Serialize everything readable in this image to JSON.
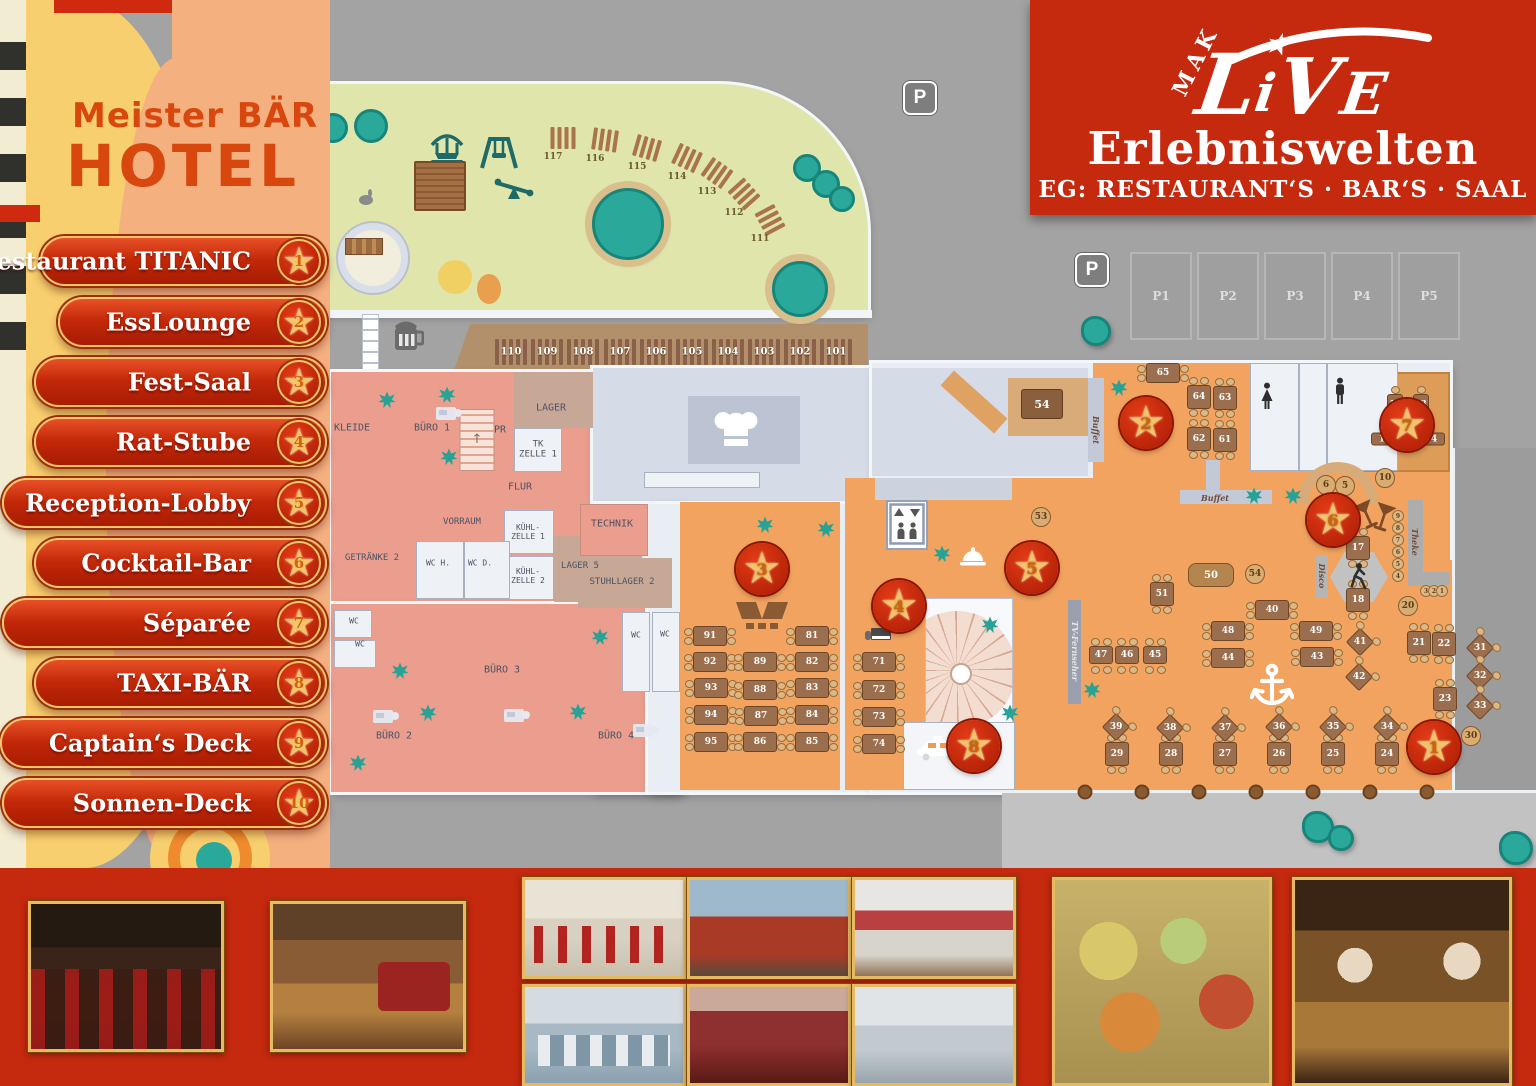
{
  "branding": {
    "hotel_line1": "Meister BÄR",
    "hotel_line2": "HOTEL",
    "mak": "MAK",
    "live_l": "L",
    "live_i": "i",
    "live_v": "V",
    "live_e": "E",
    "live_star": "★",
    "subtitle": "Erlebniswelten",
    "floor_line": "EG: RESTAURANT‘S · BAR‘S · SAAL"
  },
  "legend": {
    "items": [
      {
        "n": "1",
        "label": "Restaurant TITANIC",
        "left": 40,
        "y": 261
      },
      {
        "n": "2",
        "label": "EssLounge",
        "left": 58,
        "y": 322
      },
      {
        "n": "3",
        "label": "Fest-Saal",
        "left": 34,
        "y": 382
      },
      {
        "n": "4",
        "label": "Rat-Stube",
        "left": 34,
        "y": 442
      },
      {
        "n": "5",
        "label": "Reception-Lobby",
        "left": 2,
        "y": 503
      },
      {
        "n": "6",
        "label": "Cocktail-Bar",
        "left": 34,
        "y": 563
      },
      {
        "n": "7",
        "label": "Séparée",
        "left": 2,
        "y": 623
      },
      {
        "n": "8",
        "label": "TAXI-BÄR",
        "left": 34,
        "y": 683
      },
      {
        "n": "9",
        "label": "Captain‘s Deck",
        "left": 0,
        "y": 743
      },
      {
        "n": "10",
        "label": "Sonnen-Deck",
        "left": 2,
        "y": 803
      }
    ]
  },
  "map": {
    "stars": [
      {
        "n": "1",
        "x": 1434,
        "y": 747
      },
      {
        "n": "2",
        "x": 1146,
        "y": 423
      },
      {
        "n": "3",
        "x": 762,
        "y": 569
      },
      {
        "n": "4",
        "x": 899,
        "y": 606
      },
      {
        "n": "5",
        "x": 1032,
        "y": 568
      },
      {
        "n": "6",
        "x": 1333,
        "y": 520
      },
      {
        "n": "7",
        "x": 1407,
        "y": 425
      },
      {
        "n": "8",
        "x": 974,
        "y": 746
      }
    ],
    "room_labels": [
      {
        "t": "KLEIDE",
        "x": 352,
        "y": 428
      },
      {
        "t": "BÜRO 1",
        "x": 432,
        "y": 428
      },
      {
        "t": "PR",
        "x": 500,
        "y": 430
      },
      {
        "t": "LAGER",
        "x": 551,
        "y": 408
      },
      {
        "t": "TK\nZELLE 1",
        "x": 538,
        "y": 450,
        "fs": 9
      },
      {
        "t": "FLUR",
        "x": 520,
        "y": 487
      },
      {
        "t": "VORRAUM",
        "x": 462,
        "y": 522,
        "fs": 9
      },
      {
        "t": "GETRÄNKE 2",
        "x": 372,
        "y": 558,
        "fs": 9
      },
      {
        "t": "WC H.",
        "x": 438,
        "y": 563,
        "fs": 8
      },
      {
        "t": "WC D.",
        "x": 480,
        "y": 563,
        "fs": 8
      },
      {
        "t": "KÜHL-\nZELLE 1",
        "x": 528,
        "y": 532,
        "fs": 8
      },
      {
        "t": "KÜHL-\nZELLE 2",
        "x": 528,
        "y": 576,
        "fs": 8
      },
      {
        "t": "LAGER 5",
        "x": 580,
        "y": 566,
        "fs": 9
      },
      {
        "t": "TECHNIK",
        "x": 612,
        "y": 524
      },
      {
        "t": "STUHLLAGER 2",
        "x": 622,
        "y": 582,
        "fs": 9
      },
      {
        "t": "WC",
        "x": 354,
        "y": 621,
        "fs": 8
      },
      {
        "t": "WC",
        "x": 360,
        "y": 644,
        "fs": 8
      },
      {
        "t": "BÜRO 3",
        "x": 502,
        "y": 670
      },
      {
        "t": "BÜRO 2",
        "x": 394,
        "y": 736
      },
      {
        "t": "BÜRO 4",
        "x": 616,
        "y": 736
      },
      {
        "t": "WC",
        "x": 636,
        "y": 635,
        "fs": 8
      },
      {
        "t": "WC",
        "x": 665,
        "y": 634,
        "fs": 8
      }
    ],
    "counter_labels": [
      {
        "t": "Buffet",
        "x": 1096,
        "y": 430,
        "v": 1
      },
      {
        "t": "Buffet",
        "x": 1215,
        "y": 498
      },
      {
        "t": "Theke",
        "x": 1415,
        "y": 542,
        "v": 1
      },
      {
        "t": "Disco",
        "x": 1322,
        "y": 576,
        "v": 1
      },
      {
        "t": "TV-Fernseher",
        "x": 1075,
        "y": 651,
        "v": 1,
        "lt": 1
      }
    ],
    "tables": [
      {
        "n": "91",
        "k": "lr",
        "x": 710,
        "y": 636
      },
      {
        "n": "92",
        "k": "lr",
        "x": 710,
        "y": 662
      },
      {
        "n": "93",
        "k": "lr",
        "x": 711,
        "y": 688
      },
      {
        "n": "94",
        "k": "lr",
        "x": 711,
        "y": 715
      },
      {
        "n": "95",
        "k": "lr",
        "x": 711,
        "y": 742
      },
      {
        "n": "89",
        "k": "lr",
        "x": 760,
        "y": 662
      },
      {
        "n": "88",
        "k": "lr",
        "x": 760,
        "y": 690
      },
      {
        "n": "87",
        "k": "lr",
        "x": 761,
        "y": 716
      },
      {
        "n": "86",
        "k": "lr",
        "x": 760,
        "y": 742
      },
      {
        "n": "81",
        "k": "lr",
        "x": 812,
        "y": 636
      },
      {
        "n": "82",
        "k": "lr",
        "x": 812,
        "y": 662
      },
      {
        "n": "83",
        "k": "lr",
        "x": 812,
        "y": 688
      },
      {
        "n": "84",
        "k": "lr",
        "x": 812,
        "y": 715
      },
      {
        "n": "85",
        "k": "lr",
        "x": 812,
        "y": 742
      },
      {
        "n": "71",
        "k": "lr",
        "x": 879,
        "y": 662
      },
      {
        "n": "72",
        "k": "lr",
        "x": 879,
        "y": 690
      },
      {
        "n": "73",
        "k": "lr",
        "x": 879,
        "y": 717
      },
      {
        "n": "74",
        "k": "lr",
        "x": 879,
        "y": 744
      },
      {
        "n": "48",
        "k": "lr",
        "x": 1228,
        "y": 631
      },
      {
        "n": "44",
        "k": "lr",
        "x": 1228,
        "y": 658
      },
      {
        "n": "49",
        "k": "lr",
        "x": 1316,
        "y": 631
      },
      {
        "n": "43",
        "k": "lr",
        "x": 1317,
        "y": 657
      },
      {
        "n": "40",
        "k": "lr",
        "x": 1272,
        "y": 610
      },
      {
        "n": "65",
        "k": "lr",
        "x": 1163,
        "y": 373
      },
      {
        "n": "64",
        "k": "tb",
        "x": 1199,
        "y": 397
      },
      {
        "n": "63",
        "k": "tb",
        "x": 1225,
        "y": 398
      },
      {
        "n": "62",
        "k": "tb",
        "x": 1199,
        "y": 439
      },
      {
        "n": "61",
        "k": "tb",
        "x": 1225,
        "y": 440
      },
      {
        "n": "51",
        "k": "tb",
        "x": 1162,
        "y": 594
      },
      {
        "n": "17",
        "k": "tb",
        "x": 1358,
        "y": 548
      },
      {
        "n": "18",
        "k": "tb",
        "x": 1358,
        "y": 600
      },
      {
        "n": "29",
        "k": "tb",
        "x": 1117,
        "y": 754
      },
      {
        "n": "28",
        "k": "tb",
        "x": 1171,
        "y": 754
      },
      {
        "n": "27",
        "k": "tb",
        "x": 1225,
        "y": 754
      },
      {
        "n": "26",
        "k": "tb",
        "x": 1279,
        "y": 754
      },
      {
        "n": "25",
        "k": "tb",
        "x": 1333,
        "y": 754
      },
      {
        "n": "24",
        "k": "tb",
        "x": 1387,
        "y": 754
      },
      {
        "n": "21",
        "k": "tb",
        "x": 1419,
        "y": 643
      },
      {
        "n": "22",
        "k": "tb",
        "x": 1444,
        "y": 644
      },
      {
        "n": "23",
        "k": "tb",
        "x": 1445,
        "y": 699
      },
      {
        "n": "12",
        "k": "tbs",
        "x": 1395,
        "y": 403
      },
      {
        "n": "13",
        "k": "tbs",
        "x": 1421,
        "y": 403
      },
      {
        "n": "47",
        "k": "wd",
        "x": 1101,
        "y": 655
      },
      {
        "n": "46",
        "k": "wd",
        "x": 1127,
        "y": 655
      },
      {
        "n": "45",
        "k": "wd",
        "x": 1155,
        "y": 655
      },
      {
        "n": "41",
        "k": "di",
        "x": 1360,
        "y": 642
      },
      {
        "n": "42",
        "k": "di",
        "x": 1359,
        "y": 677
      },
      {
        "n": "39",
        "k": "di",
        "x": 1116,
        "y": 727
      },
      {
        "n": "38",
        "k": "di",
        "x": 1170,
        "y": 728
      },
      {
        "n": "37",
        "k": "di",
        "x": 1225,
        "y": 728
      },
      {
        "n": "36",
        "k": "di",
        "x": 1279,
        "y": 727
      },
      {
        "n": "35",
        "k": "di",
        "x": 1333,
        "y": 727
      },
      {
        "n": "34",
        "k": "di",
        "x": 1387,
        "y": 727
      },
      {
        "n": "31",
        "k": "di",
        "x": 1480,
        "y": 648
      },
      {
        "n": "32",
        "k": "di",
        "x": 1480,
        "y": 676
      },
      {
        "n": "33",
        "k": "di",
        "x": 1480,
        "y": 706
      },
      {
        "n": "53",
        "k": "ro",
        "x": 1041,
        "y": 517
      },
      {
        "n": "54",
        "k": "ro",
        "x": 1255,
        "y": 574
      },
      {
        "n": "10",
        "k": "ro",
        "x": 1385,
        "y": 478
      },
      {
        "n": "5",
        "k": "ro",
        "x": 1345,
        "y": 486
      },
      {
        "n": "6",
        "k": "ro",
        "x": 1326,
        "y": 485
      },
      {
        "n": "20",
        "k": "ro",
        "x": 1408,
        "y": 606
      },
      {
        "n": "30",
        "k": "ro",
        "x": 1471,
        "y": 736
      },
      {
        "n": "9",
        "k": "ti",
        "x": 1398,
        "y": 516
      },
      {
        "n": "8",
        "k": "ti",
        "x": 1398,
        "y": 528
      },
      {
        "n": "7",
        "k": "ti",
        "x": 1398,
        "y": 540
      },
      {
        "n": "6",
        "k": "ti",
        "x": 1398,
        "y": 552
      },
      {
        "n": "5",
        "k": "ti",
        "x": 1398,
        "y": 564
      },
      {
        "n": "4",
        "k": "ti",
        "x": 1398,
        "y": 576
      },
      {
        "n": "3",
        "k": "ti",
        "x": 1426,
        "y": 591
      },
      {
        "n": "2",
        "k": "ti",
        "x": 1434,
        "y": 591
      },
      {
        "n": "1",
        "k": "ti",
        "x": 1442,
        "y": 591
      },
      {
        "n": "11",
        "k": "be",
        "x": 1385,
        "y": 439
      },
      {
        "n": "14",
        "k": "be",
        "x": 1431,
        "y": 439
      },
      {
        "n": "54",
        "k": "bg",
        "x": 1042,
        "y": 404
      },
      {
        "n": "50",
        "k": "so",
        "x": 1211,
        "y": 575
      }
    ],
    "garden": {
      "loungers": [
        {
          "n": "117",
          "x": 563,
          "y": 138,
          "r": 0
        },
        {
          "n": "116",
          "x": 605,
          "y": 140,
          "r": 8
        },
        {
          "n": "115",
          "x": 647,
          "y": 148,
          "r": 16
        },
        {
          "n": "114",
          "x": 687,
          "y": 158,
          "r": 25
        },
        {
          "n": "113",
          "x": 717,
          "y": 173,
          "r": 35
        },
        {
          "n": "112",
          "x": 744,
          "y": 194,
          "r": 48
        },
        {
          "n": "111",
          "x": 770,
          "y": 220,
          "r": 62
        }
      ]
    },
    "terrace": {
      "tables": [
        {
          "n": "110",
          "x": 511
        },
        {
          "n": "109",
          "x": 547
        },
        {
          "n": "108",
          "x": 583
        },
        {
          "n": "107",
          "x": 620
        },
        {
          "n": "106",
          "x": 656
        },
        {
          "n": "105",
          "x": 692
        },
        {
          "n": "104",
          "x": 728
        },
        {
          "n": "103",
          "x": 764
        },
        {
          "n": "102",
          "x": 800
        },
        {
          "n": "101",
          "x": 836
        }
      ]
    },
    "parking": {
      "sign": "P",
      "stalls": [
        {
          "label": "P1"
        },
        {
          "label": "P2"
        },
        {
          "label": "P3"
        },
        {
          "label": "P4"
        },
        {
          "label": "P5"
        }
      ]
    },
    "icons": [
      {
        "i": "beer-mug",
        "x": 408,
        "y": 336
      },
      {
        "i": "carousel",
        "x": 447,
        "y": 147
      },
      {
        "i": "swing",
        "x": 499,
        "y": 152
      },
      {
        "i": "seesaw",
        "x": 514,
        "y": 190
      },
      {
        "i": "climbing-frame",
        "x": 440,
        "y": 186
      },
      {
        "i": "rabbit",
        "x": 366,
        "y": 200
      },
      {
        "i": "castle-tower",
        "x": 373,
        "y": 258
      },
      {
        "i": "chef-hat",
        "x": 736,
        "y": 430
      },
      {
        "i": "stage",
        "x": 762,
        "y": 615
      },
      {
        "i": "elevator",
        "x": 907,
        "y": 524
      },
      {
        "i": "reception-bell",
        "x": 973,
        "y": 557
      },
      {
        "i": "spiral-stairs",
        "x": 968,
        "y": 663
      },
      {
        "i": "stairs",
        "x": 477,
        "y": 440
      },
      {
        "i": "taxi",
        "x": 938,
        "y": 748
      },
      {
        "i": "anchor",
        "x": 1272,
        "y": 686
      },
      {
        "i": "dancer",
        "x": 1358,
        "y": 576
      },
      {
        "i": "cocktail-glasses",
        "x": 1376,
        "y": 519
      },
      {
        "i": "piano",
        "x": 878,
        "y": 637
      },
      {
        "i": "desk",
        "x": 446,
        "y": 414
      },
      {
        "i": "desk",
        "x": 383,
        "y": 717
      },
      {
        "i": "desk",
        "x": 514,
        "y": 716
      },
      {
        "i": "desk",
        "x": 643,
        "y": 731
      },
      {
        "i": "wc-woman",
        "x": 1267,
        "y": 396
      },
      {
        "i": "wc-man",
        "x": 1340,
        "y": 391
      },
      {
        "i": "p-sign",
        "x": 920,
        "y": 98
      },
      {
        "i": "p-sign",
        "x": 1092,
        "y": 270
      }
    ],
    "plants": [
      {
        "x": 387,
        "y": 400
      },
      {
        "x": 447,
        "y": 395
      },
      {
        "x": 449,
        "y": 457
      },
      {
        "x": 400,
        "y": 671
      },
      {
        "x": 428,
        "y": 713
      },
      {
        "x": 600,
        "y": 637
      },
      {
        "x": 578,
        "y": 712
      },
      {
        "x": 765,
        "y": 525
      },
      {
        "x": 826,
        "y": 529
      },
      {
        "x": 942,
        "y": 554
      },
      {
        "x": 990,
        "y": 625
      },
      {
        "x": 1010,
        "y": 713
      },
      {
        "x": 1119,
        "y": 388
      },
      {
        "x": 1254,
        "y": 496
      },
      {
        "x": 1293,
        "y": 496
      },
      {
        "x": 1092,
        "y": 690
      },
      {
        "x": 358,
        "y": 763
      }
    ],
    "bushes": [
      {
        "x": 1318,
        "y": 827,
        "s": 26
      },
      {
        "x": 1341,
        "y": 838,
        "s": 20
      },
      {
        "x": 1516,
        "y": 848,
        "s": 28
      },
      {
        "x": 1096,
        "y": 331,
        "s": 24
      }
    ],
    "trees": [
      {
        "x": 333,
        "y": 128,
        "r": 12
      },
      {
        "x": 371,
        "y": 126,
        "r": 14
      },
      {
        "x": 628,
        "y": 224,
        "r": 33,
        "ring": 1
      },
      {
        "x": 800,
        "y": 289,
        "r": 25,
        "ring": 1
      },
      {
        "x": 807,
        "y": 168,
        "r": 11
      },
      {
        "x": 826,
        "y": 184,
        "r": 11
      },
      {
        "x": 842,
        "y": 199,
        "r": 10
      }
    ],
    "planters": [
      1085,
      1142,
      1199,
      1256,
      1313,
      1370,
      1427
    ]
  },
  "photos": [
    {
      "name": "restaurant-interior",
      "x": 28,
      "y": 901,
      "w": 196,
      "h": 151,
      "cls": "p1"
    },
    {
      "name": "reception-lobby",
      "x": 270,
      "y": 901,
      "w": 196,
      "h": 151,
      "cls": "p2"
    },
    {
      "name": "banquet-hall",
      "x": 522,
      "y": 877,
      "w": 164,
      "h": 102,
      "cls": "p3"
    },
    {
      "name": "event-hall",
      "x": 522,
      "y": 984,
      "w": 164,
      "h": 102,
      "cls": "p4"
    },
    {
      "name": "hotel-exterior",
      "x": 687,
      "y": 877,
      "w": 164,
      "h": 102,
      "cls": "p5"
    },
    {
      "name": "red-lounge",
      "x": 687,
      "y": 984,
      "w": 164,
      "h": 102,
      "cls": "p6"
    },
    {
      "name": "hotel-bedroom",
      "x": 852,
      "y": 877,
      "w": 164,
      "h": 102,
      "cls": "p7"
    },
    {
      "name": "bathroom",
      "x": 852,
      "y": 984,
      "w": 164,
      "h": 102,
      "cls": "p8"
    },
    {
      "name": "buffet-food",
      "x": 1052,
      "y": 877,
      "w": 220,
      "h": 209,
      "cls": "p9"
    },
    {
      "name": "cocktail-bar-staff",
      "x": 1292,
      "y": 877,
      "w": 220,
      "h": 209,
      "cls": "p10"
    }
  ]
}
